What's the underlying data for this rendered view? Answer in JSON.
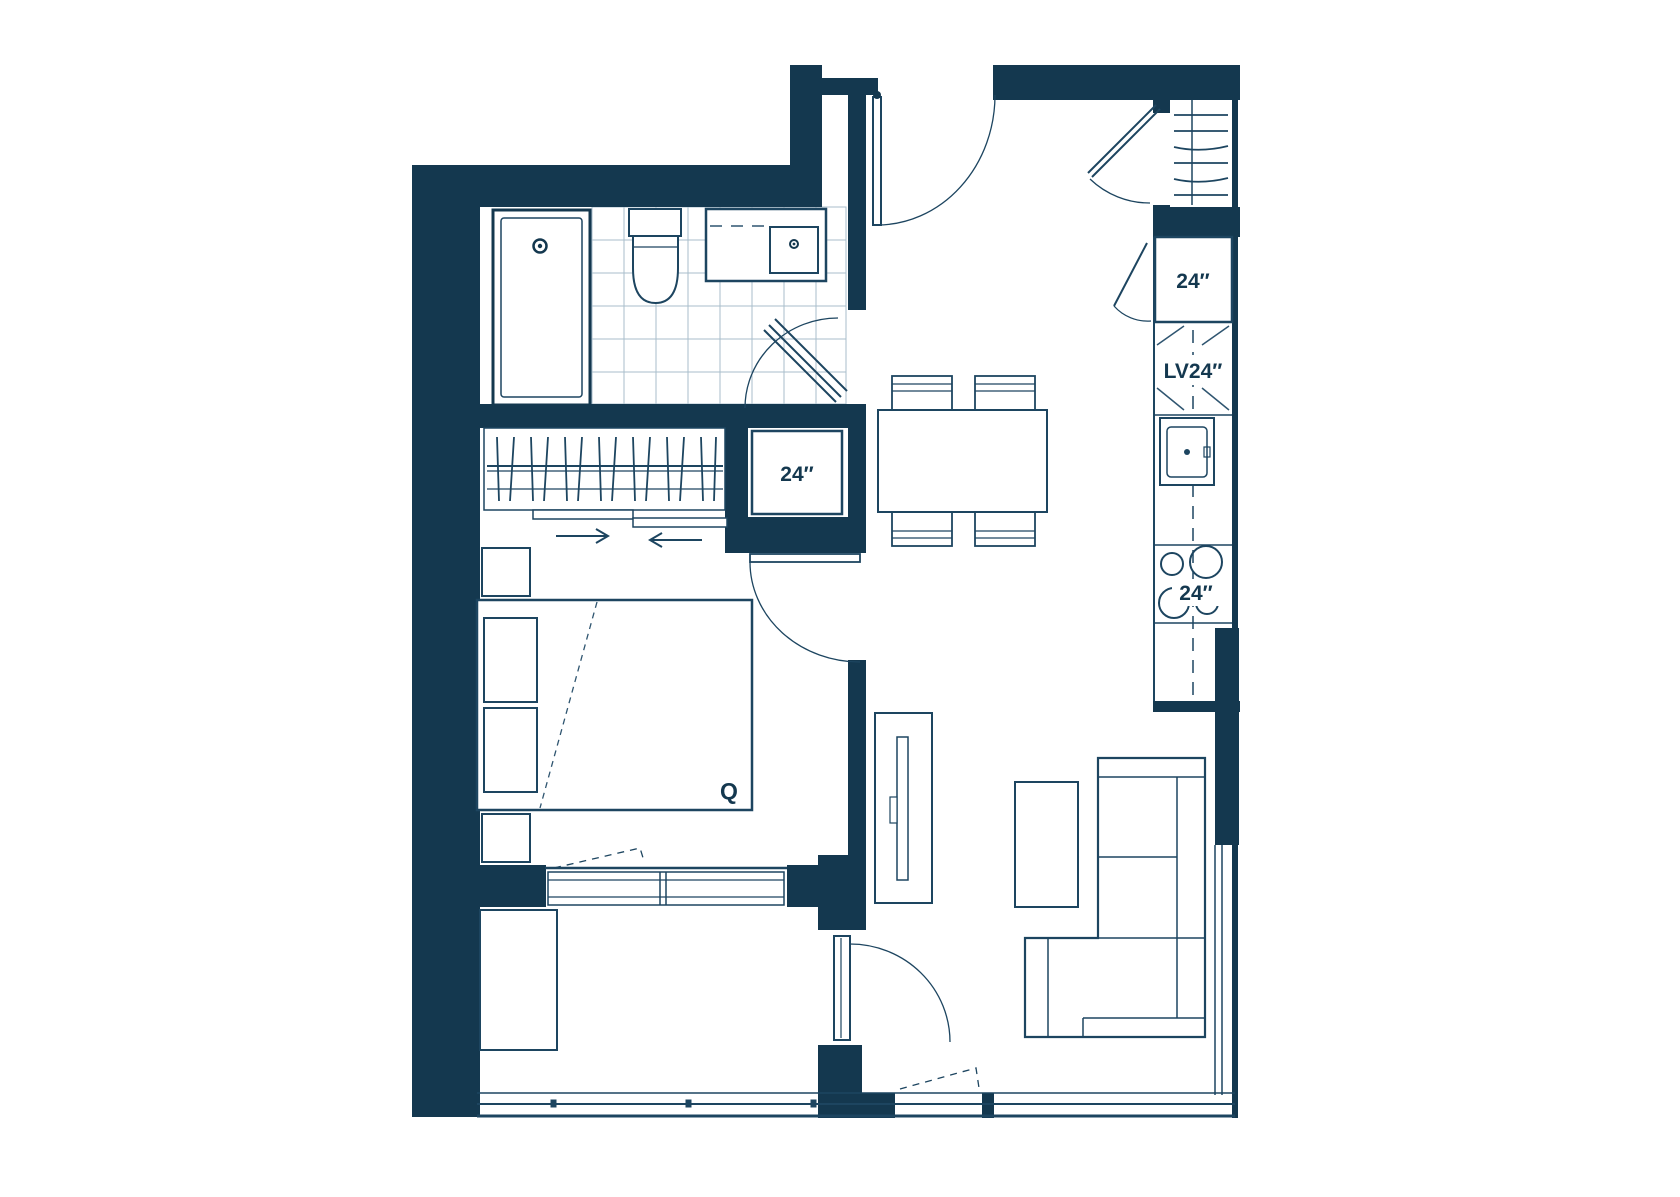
{
  "title": "One-bedroom apartment floor plan",
  "colors": {
    "background": "#ffffff",
    "wall": "#14384F",
    "fixture_line": "#1D4560",
    "detail_line": "#2F5570",
    "tile_line": "#A9BDCB",
    "label_text": "#14384F"
  },
  "labels": {
    "linen_closet": "24″",
    "fridge": "24″",
    "dishwasher": "LV24″",
    "range": "24″",
    "bed": "Q"
  },
  "rooms": {
    "bathroom": [
      "bathtub",
      "toilet",
      "vanity-sink",
      "tiled-floor",
      "pivot-door"
    ],
    "bedroom": [
      "queen-bed",
      "pillows",
      "nightstands",
      "wardrobe-with-hangers",
      "sliding-closet-doors",
      "window",
      "swing-door"
    ],
    "entry": [
      "entry-door",
      "coat-closet-with-hangers",
      "closet-pivot-door"
    ],
    "kitchen": [
      "refrigerator",
      "dishwasher",
      "kitchen-sink",
      "range-4-burners",
      "counter"
    ],
    "living-dining": [
      "dining-table",
      "four-chairs",
      "tv-unit",
      "coffee-table",
      "sectional-sofa",
      "balcony-door",
      "windows"
    ],
    "balcony": [
      "planter-box",
      "glass-railing"
    ]
  }
}
